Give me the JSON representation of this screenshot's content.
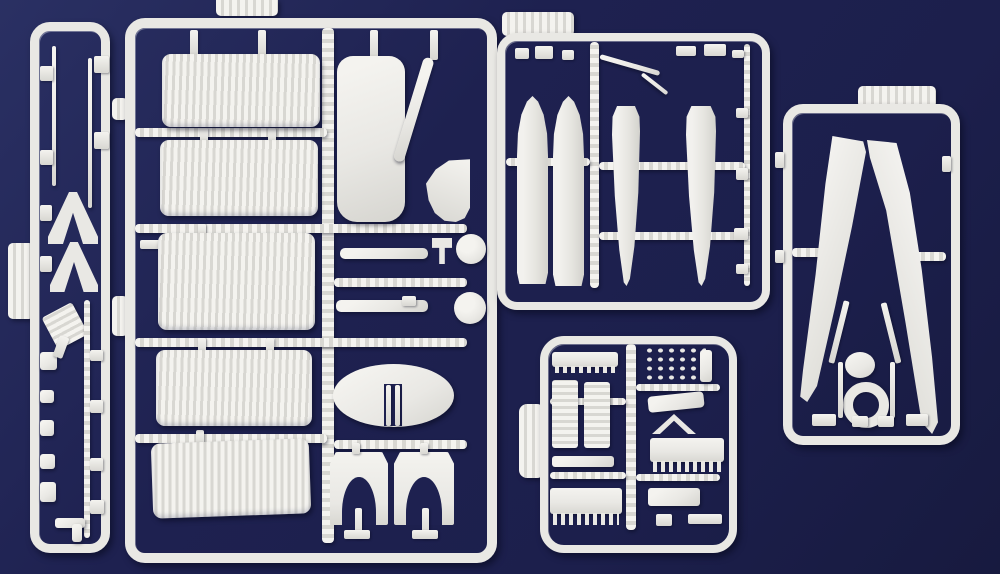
{
  "scene": {
    "description": "photograph of five light-grey injection-moulded model-kit sprues on a dark navy background",
    "colors": {
      "bg": "#1e2150",
      "bg-light": "#2a3063",
      "bg-dark": "#171a3f",
      "pl": "#e9e8e4",
      "pl-br": "#f4f3ef",
      "pl-md": "#d8d7d2",
      "pl-sh": "#b3b6c4"
    }
  },
  "sprues": [
    {
      "id": "narrow-strut-sprue",
      "label": "tall narrow sprue with wing struts, A-frame struts, ladder and small fittings",
      "parts": [
        "wing-strut",
        "wing-strut",
        "a-frame-strut",
        "a-frame-strut",
        "boarding-ladder",
        "small-fitting",
        "small-fitting",
        "small-fitting",
        "small-fitting",
        "edge-tab"
      ]
    },
    {
      "id": "wing-panel-sprue",
      "label": "large sprue with five corrugated wing panels, outer wing, propeller blade, fillet, cowl strips, engine discs, centre oval and two cowl arches",
      "parts": [
        "corrugated-wing-panel",
        "corrugated-wing-panel",
        "corrugated-wing-panel",
        "corrugated-wing-panel",
        "corrugated-wing-panel",
        "outer-wing-panel",
        "propeller-blade",
        "wing-fillet",
        "cowl-strip",
        "cowl-strip",
        "prong-fitting",
        "engine-disc",
        "engine-disc",
        "centre-oval",
        "cowl-arch",
        "cowl-arch",
        "top-tab"
      ]
    },
    {
      "id": "float-sprue",
      "label": "sprue with four long float and fuselage halves plus small canopy strips",
      "parts": [
        "float-half",
        "float-half",
        "fuselage-half",
        "fuselage-half",
        "canopy-strip",
        "small-clip",
        "small-clip",
        "small-clip",
        "top-tab"
      ]
    },
    {
      "id": "detail-parts-sprue",
      "label": "small sprue crowded with engine cylinder banks, radiator grid and brackets",
      "parts": [
        "cylinder-bank",
        "cylinder-bank",
        "cylinder-bank",
        "cylinder-bank",
        "radiator-grid",
        "bracket",
        "bracket",
        "chevron-fitting",
        "edge-tab"
      ]
    },
    {
      "id": "wing-half-sprue",
      "label": "sprue with two tapered upper-wing halves, engine ring and hub",
      "parts": [
        "tapered-wing-half",
        "tapered-wing-half",
        "engine-ring",
        "hub-part",
        "top-tab"
      ]
    }
  ]
}
